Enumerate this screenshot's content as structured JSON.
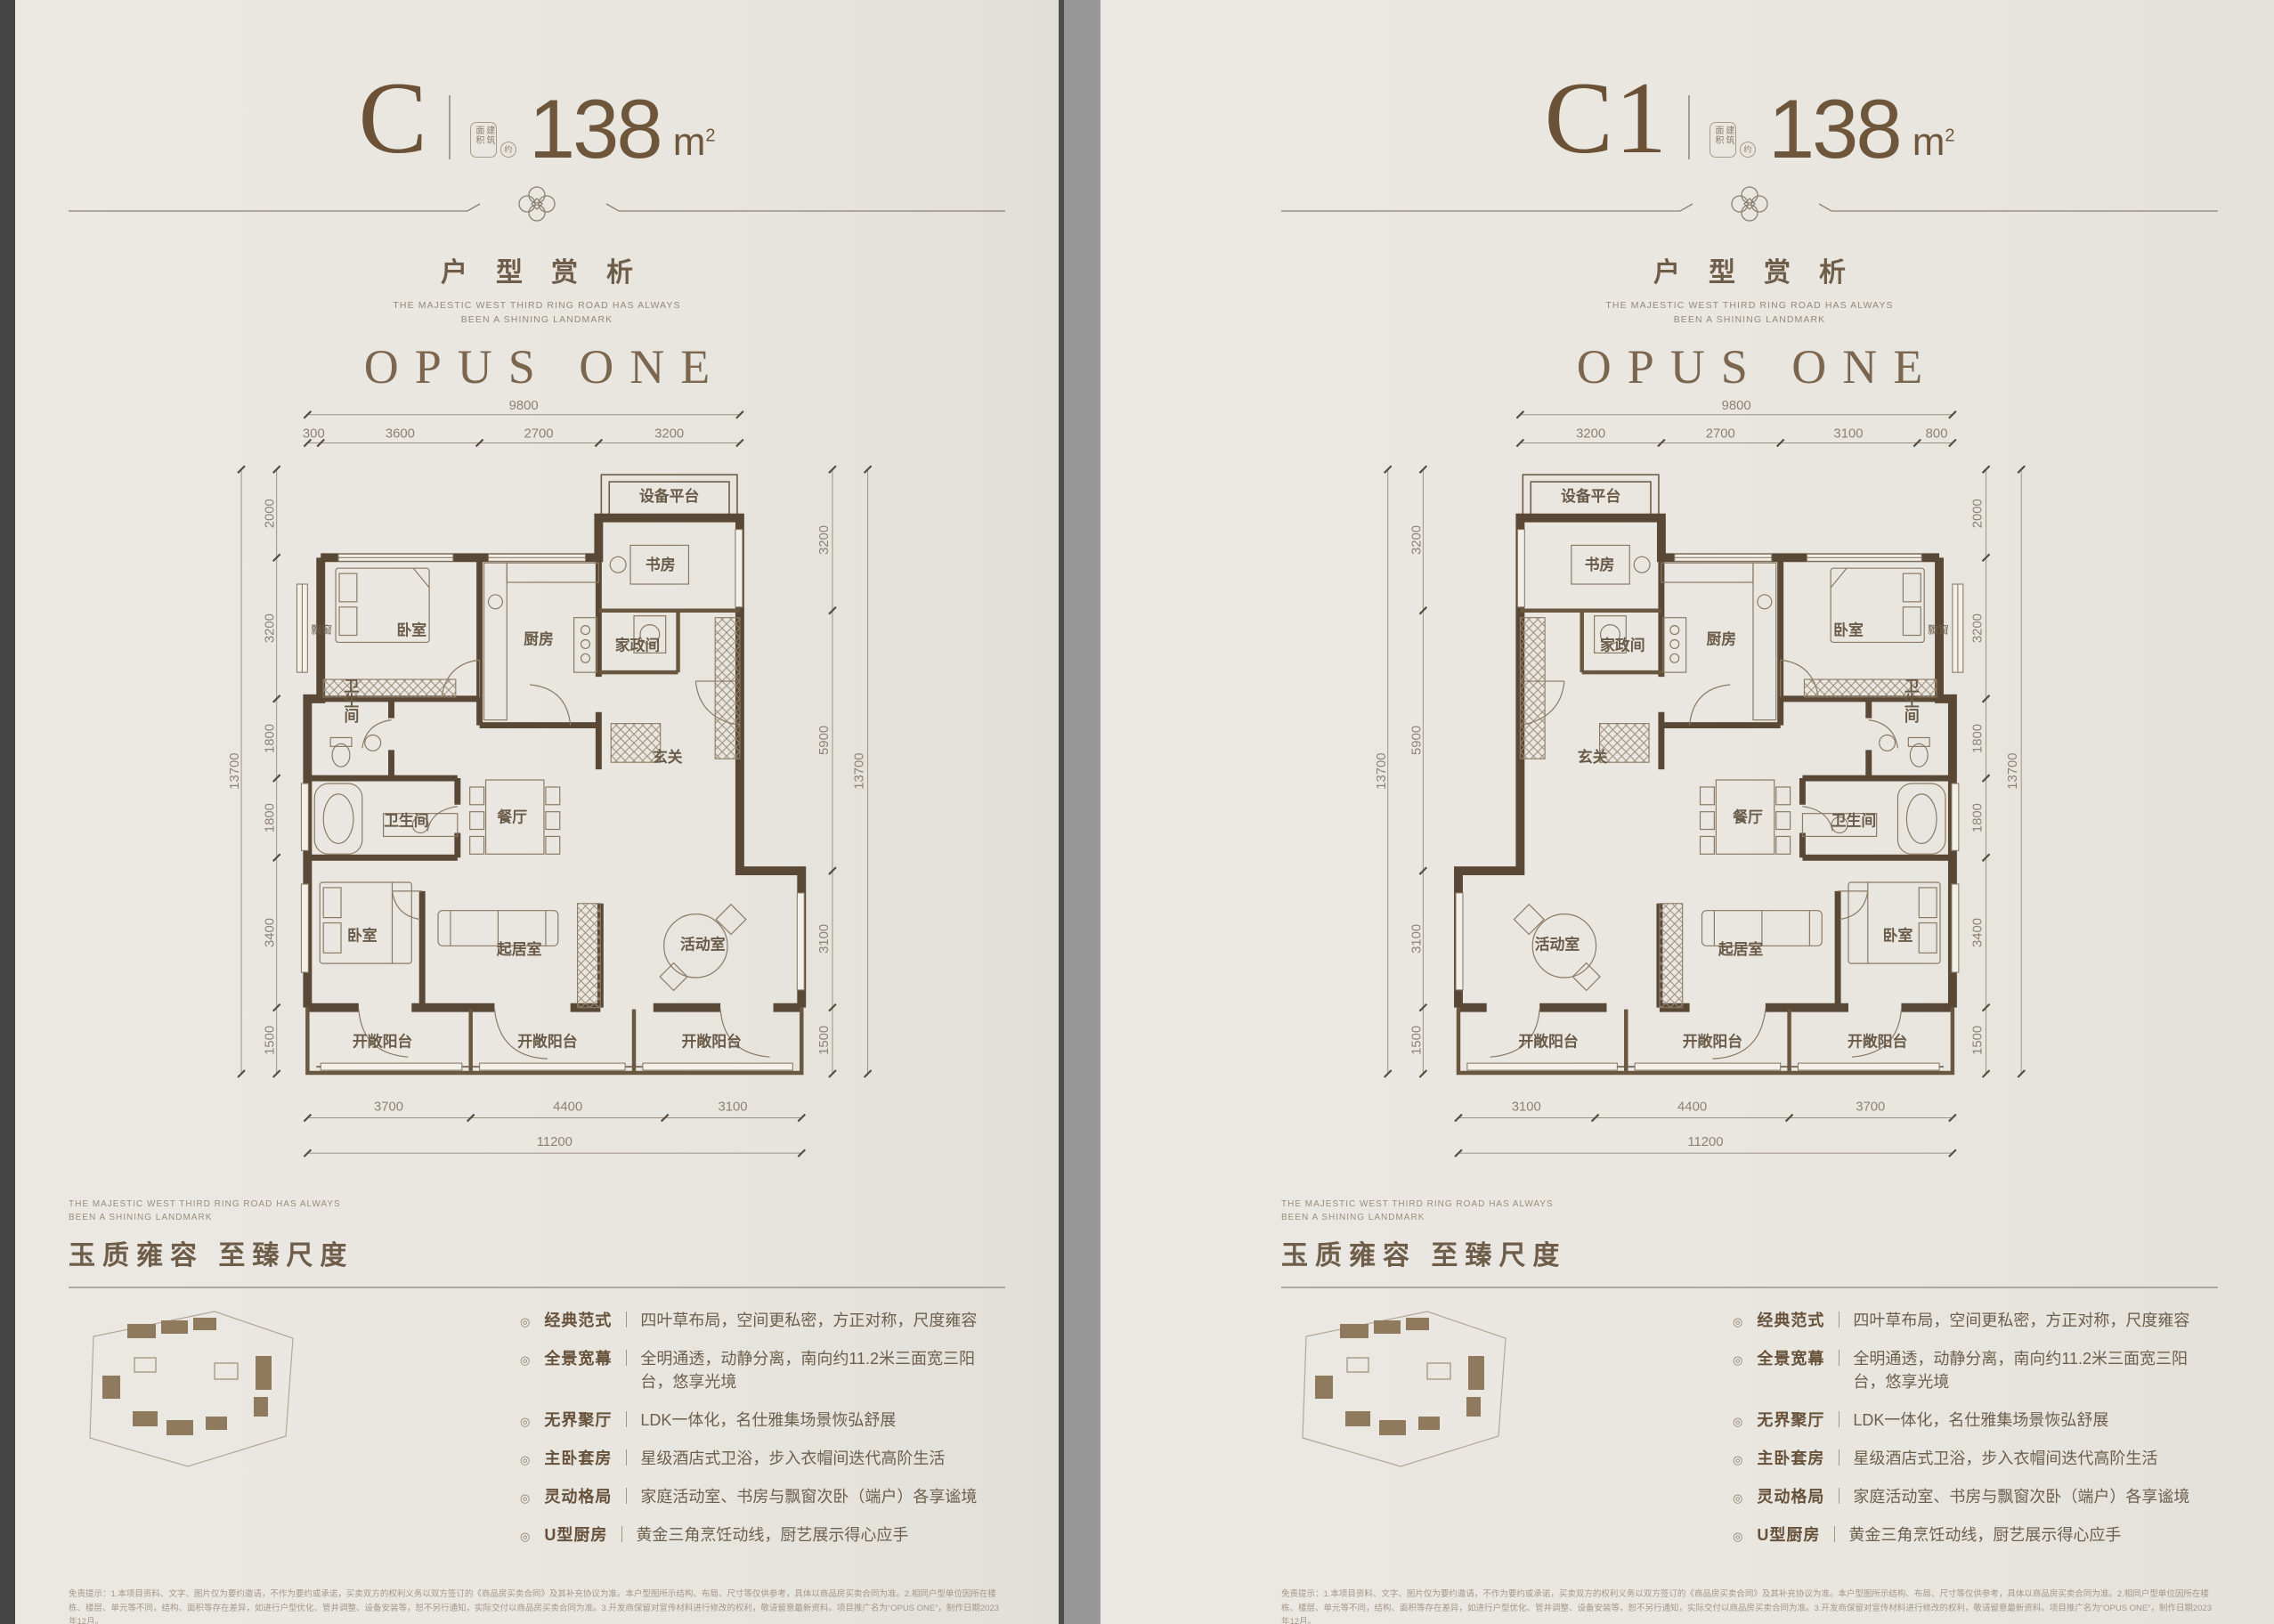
{
  "header": {
    "area_label": "建筑面积",
    "approx": "约",
    "area_unit_m": "m",
    "area_unit_exp": "2",
    "section_title": "户型赏析",
    "sub1": "THE MAJESTIC WEST THIRD RING ROAD HAS ALWAYS",
    "sub2": "BEEN A SHINING LANDMARK",
    "brand": "OPUS ONE"
  },
  "rooms": {
    "equipment": "设备平台",
    "study": "书房",
    "housekeeping": "家政间",
    "kitchen": "厨房",
    "bedroom1": "卧室",
    "bay_window": "飘窗",
    "bath1": "卫生间",
    "bath2": "卫生间",
    "foyer": "玄关",
    "dining": "餐厅",
    "living": "起居室",
    "activity": "活动室",
    "bedroom2": "卧室",
    "balcony1": "开敞阳台",
    "balcony2": "开敞阳台",
    "balcony3": "开敞阳台"
  },
  "pages": [
    {
      "unit": "C",
      "area_num": "138",
      "dims": {
        "top_total": "9800",
        "top": [
          "300",
          "3600",
          "2700",
          "3200"
        ],
        "left_total": "13700",
        "left": [
          "2000",
          "3200",
          "1800",
          "1800",
          "3400",
          "1500"
        ],
        "right_total": "13700",
        "right": [
          "3200",
          "5900",
          "3100",
          "1500"
        ],
        "bottom_total": "11200",
        "bottom": [
          "3700",
          "4400",
          "3100"
        ]
      }
    },
    {
      "unit": "C1",
      "area_num": "138",
      "dims": {
        "top_total": "9800",
        "top": [
          "3200",
          "2700",
          "3100",
          "800"
        ],
        "left_total": "13700",
        "left": [
          "3200",
          "5900",
          "3100",
          "1500"
        ],
        "right_total": "13700",
        "right": [
          "2000",
          "3200",
          "1800",
          "1800",
          "3400",
          "1500"
        ],
        "bottom_total": "11200",
        "bottom": [
          "3100",
          "4400",
          "3700"
        ]
      }
    }
  ],
  "footer": {
    "en1": "THE MAJESTIC WEST THIRD RING ROAD HAS ALWAYS",
    "en2": "BEEN A SHINING LANDMARK",
    "cn": "玉质雍容 至臻尺度",
    "bullet": "◎",
    "sep": "｜",
    "features": [
      {
        "t": "经典范式",
        "d": "四叶草布局，空间更私密，方正对称，尺度雍容"
      },
      {
        "t": "全景宽幕",
        "d": "全明通透，动静分离，南向约11.2米三面宽三阳台，悠享光境"
      },
      {
        "t": "无界聚厅",
        "d": "LDK一体化，名仕雅集场景恢弘舒展"
      },
      {
        "t": "主卧套房",
        "d": "星级酒店式卫浴，步入衣帽间迭代高阶生活"
      },
      {
        "t": "灵动格局",
        "d": "家庭活动室、书房与飘窗次卧（端户）各享谧境"
      },
      {
        "t": "U型厨房",
        "d": "黄金三角烹饪动线，厨艺展示得心应手"
      }
    ],
    "disclaimer": "免责提示：1.本项目资料、文字、图片仅为要约邀请，不作为要约或承诺，买卖双方的权利义务以双方签订的《商品房买卖合同》及其补充协议为准。本户型图所示结构、布局、尺寸等仅供参考，具体以商品房买卖合同为准。2.相同户型单位因所在楼栋、楼层、单元等不同，结构、面积等存在差异，如进行户型优化、管井调整、设备安装等，恕不另行通知，实际交付以商品房买卖合同为准。3.开发商保留对宣传材料进行修改的权利，敬请留意最新资料。项目推广名为“OPUS ONE”，制作日期2023年12月。"
  }
}
